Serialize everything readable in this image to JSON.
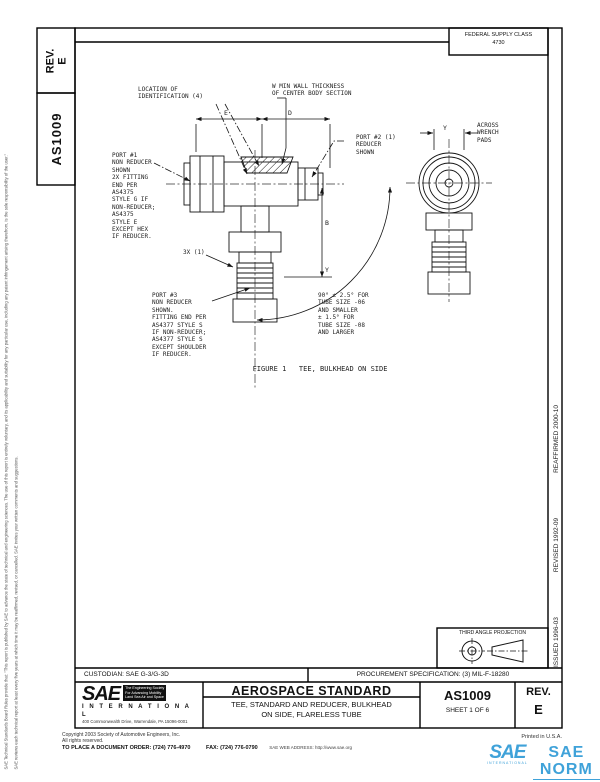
{
  "header": {
    "rev_label": "REV.",
    "rev_value": "E",
    "doc_number": "AS1009",
    "fsc_line1": "FEDERAL SUPPLY CLASS",
    "fsc_line2": "4730"
  },
  "margins": {
    "issued": "ISSUED 1996-03",
    "revised": "REVISED 1992-09",
    "reaffirmed": "REAFFIRMED 2000-10",
    "disclaimer_col1": "SAE Technical Standards Board Rules provide that: \"This report is published by SAE to advance the state of technical and engineering sciences. The use of this report is entirely voluntary, and its applicability and suitability for any particular use, including any patent infringement arising therefrom, is the sole responsibility of the user.\"",
    "disclaimer_col2": "SAE reviews each technical report at least every five years at which time it may be reaffirmed, revised, or cancelled. SAE invites your written comments and suggestions."
  },
  "drawing": {
    "label_location_id": "LOCATION OF\nIDENTIFICATION (4)",
    "label_wall": "W MIN WALL THICKNESS\nOF CENTER BODY SECTION",
    "label_port1": "PORT #1\nNON REDUCER\nSHOWN\n2X FITTING\nEND PER\nAS4375\nSTYLE G IF\nNON-REDUCER;\nAS4375\nSTYLE E\nEXCEPT HEX\nIF REDUCER.",
    "label_port2": "PORT #2 (1)\nREDUCER\nSHOWN",
    "label_port3": "PORT #3\nNON REDUCER\nSHOWN.\nFITTING END PER\nAS4377 STYLE S\nIF NON-REDUCER;\nAS4377 STYLE S\nEXCEPT SHOULDER\nIF REDUCER.",
    "label_places": "3X (1)",
    "label_angle": "90° ± 2.5° FOR\nTUBE SIZE -06\nAND SMALLER\n± 1.5° FOR\nTUBE SIZE -08\nAND LARGER",
    "label_across": "ACROSS\nWRENCH\nPADS",
    "dim_e": "E",
    "dim_d": "D",
    "dim_b": "B",
    "dim_y_side": "Y",
    "dim_y_main": "Y",
    "caption": "FIGURE 1   TEE, BULKHEAD ON SIDE"
  },
  "projection_box": {
    "title": "THIRD ANGLE PROJECTION"
  },
  "title_block": {
    "custodian": "CUSTODIAN: SAE G-3/G-3D",
    "procurement": "PROCUREMENT SPECIFICATION: (3) MIL-F-18280",
    "standard_type": "AEROSPACE STANDARD",
    "title": "TEE, STANDARD AND REDUCER, BULKHEAD\nON SIDE, FLARELESS TUBE",
    "doc_number": "AS1009",
    "sheet": "SHEET 1 OF 6",
    "rev_label": "REV.",
    "rev_value": "E",
    "sae_logo": "SAE",
    "sae_tagline": "The Engineering Society\nFor Advancing Mobility\nLand Sea Air and Space",
    "sae_international": "I N T E R N A T I O N A L",
    "sae_address": "400 Commonwealth Drive, Warrendale, PA 15096-0001"
  },
  "footer": {
    "copyright1": "Copyright 2003 Society of Automotive Engineers, Inc.",
    "copyright2": "All rights reserved.",
    "order": "TO PLACE A DOCUMENT ORDER:",
    "order_phone": "(724) 776-4970",
    "fax_label": "FAX:",
    "fax_phone": "(724) 776-0790",
    "web": "SAE WEB ADDRESS:  http://www.sae.org",
    "printed": "Printed in U.S.A."
  },
  "watermark": {
    "logo": "SAE",
    "logo_sub": "INTERNATIONAL",
    "name": "SAE NORM"
  }
}
